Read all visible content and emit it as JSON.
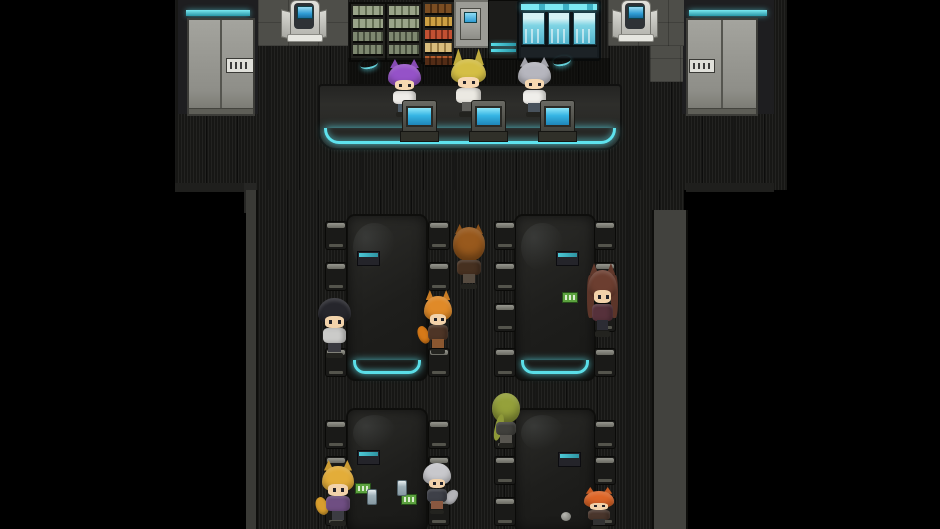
{
  "scene": {
    "description": "Top-down sci-fi cafeteria and shop interior with animal-eared chibi characters, dark striped floor and cyan-glowing counter and tables",
    "readable_text": []
  },
  "palette": {
    "background": "#000000",
    "floor": "#171715",
    "accent_teal": "#5adee8",
    "wall_grey": "#9c9c96",
    "tile_grey": "#4e4e49",
    "furniture_dark": "#232321",
    "register_screen_blue": "#35b4e4",
    "case_glass_blue": "#7fd4e4",
    "skin": "#f2d2aa"
  },
  "shop": {
    "doors": [
      {
        "id": "door-left",
        "sign": "unreadable-pixel-plate"
      },
      {
        "id": "door-right",
        "sign": "unreadable-pixel-plate"
      }
    ],
    "kiosks": [
      {
        "id": "kiosk-left-terminal",
        "x": 281,
        "y": 0
      },
      {
        "id": "kiosk-right-terminal",
        "x": 612,
        "y": 0
      }
    ],
    "registers": [
      {
        "x": 402,
        "y": 100
      },
      {
        "x": 471,
        "y": 100
      },
      {
        "x": 540,
        "y": 100
      }
    ],
    "decals": [
      {
        "x": 360,
        "y": 59
      },
      {
        "x": 553,
        "y": 56
      }
    ]
  },
  "seating": {
    "tables": [
      {
        "id": "table-top-left",
        "x": 346,
        "y": 214,
        "w": 78,
        "h": 163,
        "glow": true
      },
      {
        "id": "table-top-right",
        "x": 514,
        "y": 214,
        "w": 78,
        "h": 163,
        "glow": true
      },
      {
        "id": "table-bottom-left",
        "x": 346,
        "y": 408,
        "w": 78,
        "h": 121,
        "glow": false
      },
      {
        "id": "table-bottom-right",
        "x": 514,
        "y": 408,
        "w": 78,
        "h": 121,
        "glow": false
      }
    ],
    "chairs": [
      [
        325,
        221
      ],
      [
        325,
        262
      ],
      [
        325,
        303
      ],
      [
        325,
        348
      ],
      [
        428,
        221
      ],
      [
        428,
        262
      ],
      [
        428,
        303
      ],
      [
        428,
        348
      ],
      [
        494,
        221
      ],
      [
        494,
        262
      ],
      [
        494,
        303
      ],
      [
        494,
        348
      ],
      [
        594,
        221
      ],
      [
        594,
        262
      ],
      [
        594,
        303
      ],
      [
        594,
        348
      ],
      [
        325,
        420
      ],
      [
        325,
        456
      ],
      [
        325,
        497
      ],
      [
        428,
        420
      ],
      [
        428,
        456
      ],
      [
        428,
        497
      ],
      [
        494,
        420
      ],
      [
        494,
        456
      ],
      [
        494,
        497
      ],
      [
        594,
        420
      ],
      [
        594,
        456
      ],
      [
        594,
        497
      ]
    ],
    "props": [
      {
        "type": "menu",
        "x": 357,
        "y": 251
      },
      {
        "type": "menu",
        "x": 556,
        "y": 251
      },
      {
        "type": "menu",
        "x": 357,
        "y": 450
      },
      {
        "type": "menu",
        "x": 558,
        "y": 452
      },
      {
        "type": "green",
        "x": 562,
        "y": 292
      },
      {
        "type": "green",
        "x": 355,
        "y": 483
      },
      {
        "type": "green",
        "x": 401,
        "y": 494
      },
      {
        "type": "can",
        "x": 367,
        "y": 489
      },
      {
        "type": "can",
        "x": 397,
        "y": 480
      },
      {
        "type": "ball",
        "x": 561,
        "y": 512
      }
    ]
  },
  "characters": [
    {
      "id": "clerk-purple-hair",
      "x": 388,
      "y": 59,
      "w": 33,
      "h": 58,
      "hair": "#9552c8",
      "skin": "#f6d8b2",
      "outfit": "#efede9",
      "pants": "#4c5a66",
      "ears": 1
    },
    {
      "id": "clerk-blonde",
      "x": 451,
      "y": 53,
      "w": 35,
      "h": 64,
      "hair": "#d4be44",
      "skin": "#f6d8b2",
      "outfit": "#ebe9e2",
      "pants": "#60605c",
      "ears": 2
    },
    {
      "id": "clerk-silver",
      "x": 518,
      "y": 57,
      "w": 33,
      "h": 60,
      "hair": "#b6b6be",
      "skin": "#f6d8b2",
      "outfit": "#efeeea",
      "pants": "#48525c",
      "ears": 1
    },
    {
      "id": "patron-black-hair",
      "x": 318,
      "y": 292,
      "w": 33,
      "h": 66,
      "hair": "#26262c",
      "skin": "#f2d2aa",
      "outfit": "#cbcbc9",
      "pants": "#3a3a40",
      "ears": 0
    },
    {
      "id": "patron-orange-fox",
      "x": 424,
      "y": 290,
      "w": 28,
      "h": 64,
      "hair": "#e08a28",
      "skin": "#f2d2aa",
      "outfit": "#4e3526",
      "pants": "#8a5730",
      "ears": 1,
      "tail": "#d67918",
      "tail_side": "l"
    },
    {
      "id": "patron-wolf-back",
      "x": 453,
      "y": 224,
      "w": 32,
      "h": 65,
      "hair": "#98591d",
      "outfit": "#463020",
      "pants": "#564b40",
      "ears": 1,
      "back": true
    },
    {
      "id": "patron-brunette",
      "x": 588,
      "y": 263,
      "w": 29,
      "h": 74,
      "hair": "#6c3e30",
      "skin": "#f2d2aa",
      "outfit": "#56313b",
      "pants": "#2c2c34",
      "ears": 1,
      "long": true
    },
    {
      "id": "patron-gold-fox",
      "x": 322,
      "y": 460,
      "w": 32,
      "h": 66,
      "hair": "#e3ad39",
      "skin": "#f2d2aa",
      "outfit": "#6f4e82",
      "pants": "#3c3c42",
      "ears": 1,
      "tail": "#d89e2e",
      "tail_side": "l"
    },
    {
      "id": "patron-silver-tail",
      "x": 423,
      "y": 458,
      "w": 28,
      "h": 56,
      "hair": "#c8c8cc",
      "skin": "#f2d2aa",
      "outfit": "#3e4048",
      "pants": "#8a5840",
      "ears": 0,
      "tail": "#b4b4b8",
      "tail_side": "r"
    },
    {
      "id": "patron-green-back",
      "x": 492,
      "y": 390,
      "w": 28,
      "h": 58,
      "hair": "#95a13b",
      "outfit": "#40403c",
      "pants": "#585650",
      "ears": 0,
      "back": true,
      "ponytail": true
    },
    {
      "id": "patron-red-panda",
      "x": 584,
      "y": 487,
      "w": 30,
      "h": 42,
      "hair": "#dd6527",
      "skin": "#f2d2aa",
      "outfit": "#4a362c",
      "pants": "#323232",
      "ears": 1
    }
  ]
}
